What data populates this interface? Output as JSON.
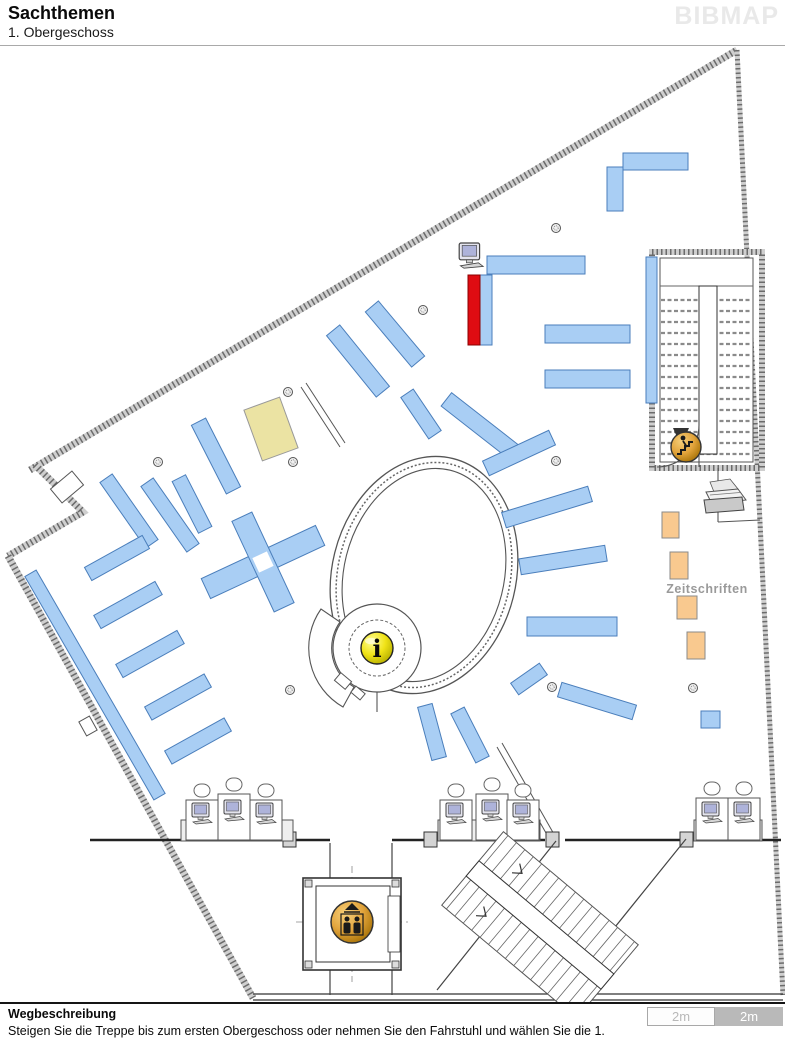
{
  "header": {
    "title": "Sachthemen",
    "subtitle": "1. Obergeschoss",
    "brand": "BIBMAP"
  },
  "map": {
    "zeitschriften_label": "Zeitschriften",
    "info_glyph": "i",
    "colors": {
      "shelf_blue": "#A9CEF4",
      "shelf_border": "#4A7EBB",
      "highlight_red": "#DF0C12",
      "shelf_beige": "#EBE3A3",
      "shelf_orange": "#F9C98F",
      "info_yellow": "#F0E317",
      "icon_amber": "#E2A43C",
      "wall_gray": "#C9C9C9",
      "label_gray": "#9A9A9A"
    }
  },
  "footer": {
    "heading": "Wegbeschreibung",
    "instruction": "Steigen Sie die Treppe bis zum ersten Obergeschoss oder nehmen Sie den Fahrstuhl und wählen Sie die 1.",
    "scale_left_label": "2m",
    "scale_right_label": "2m"
  }
}
